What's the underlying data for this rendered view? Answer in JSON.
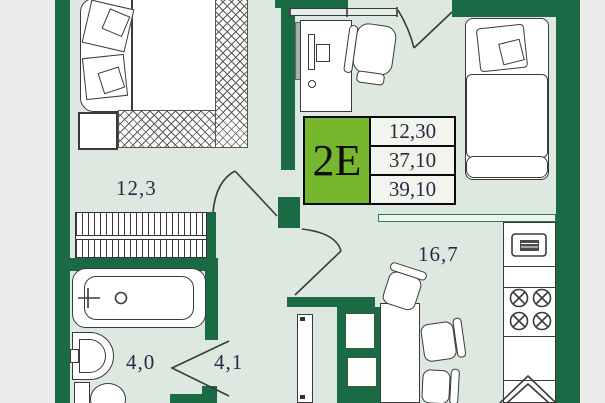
{
  "plan": {
    "unit": {
      "label": "2E",
      "values": [
        "12,30",
        "37,10",
        "39,10"
      ]
    },
    "rooms": {
      "bedroom": {
        "area": "12,3"
      },
      "bathroom": {
        "area": "4,0"
      },
      "hallway": {
        "area": "4,1"
      },
      "kitchen_living": {
        "area": "16,7"
      }
    },
    "colors": {
      "wall": "#1a6a43",
      "floor": "#dce8e0",
      "outside": "#ecebe9",
      "accent_green": "#77b72e"
    }
  }
}
